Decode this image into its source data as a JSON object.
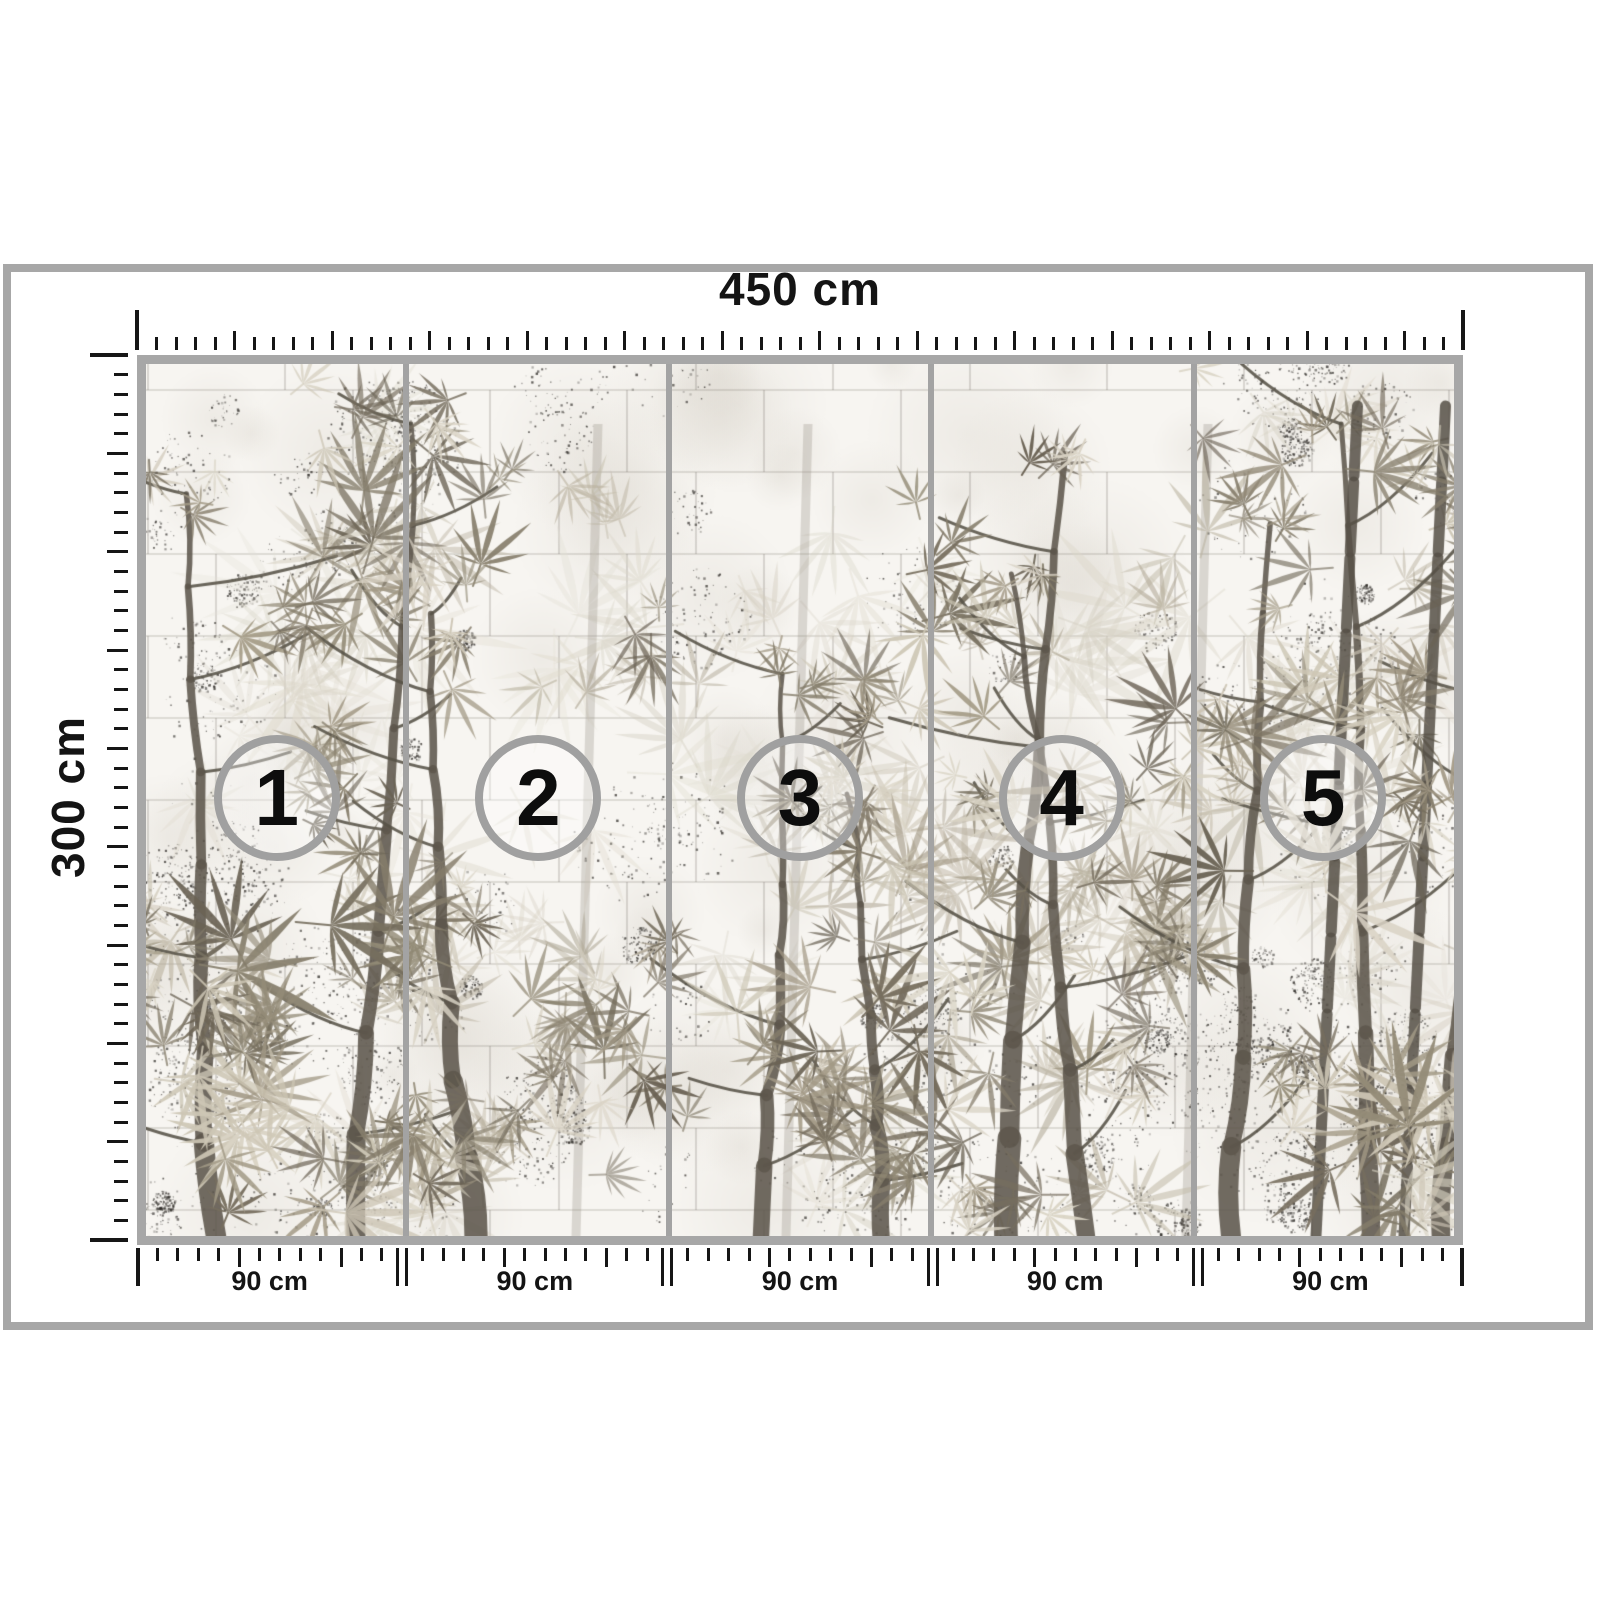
{
  "diagram": {
    "kind": "wallpaper mural panel size diagram"
  },
  "dimensions": {
    "total_width": "450 cm",
    "total_height": "300 cm"
  },
  "panels": [
    {
      "number": "1",
      "width_label": "90 cm"
    },
    {
      "number": "2",
      "width_label": "90 cm"
    },
    {
      "number": "3",
      "width_label": "90 cm"
    },
    {
      "number": "4",
      "width_label": "90 cm"
    },
    {
      "number": "5",
      "width_label": "90 cm"
    }
  ],
  "colors": {
    "frame": "#a7a7a7",
    "divider": "#a3a3a3",
    "circle_stroke": "#a0a0a0",
    "tick": "#161616",
    "text": "#141414",
    "artwork": {
      "wall": "#f7f5f1",
      "block_line": "rgba(110,104,96,0.38)",
      "speckle": "rgba(45,42,38,",
      "ghost": [
        "#e3dfd4",
        "#dcd7c9",
        "#d2cdbe"
      ],
      "mid": [
        "#c6bfad",
        "#b9b19e",
        "#aca491"
      ],
      "fore": [
        "#a39a86",
        "#948c78",
        "#857d6b",
        "#766e5e",
        "#6a6254",
        "#d9d3c4",
        "#cdc6b5"
      ],
      "trunk": "#5d574c",
      "branch": "#575247"
    }
  }
}
